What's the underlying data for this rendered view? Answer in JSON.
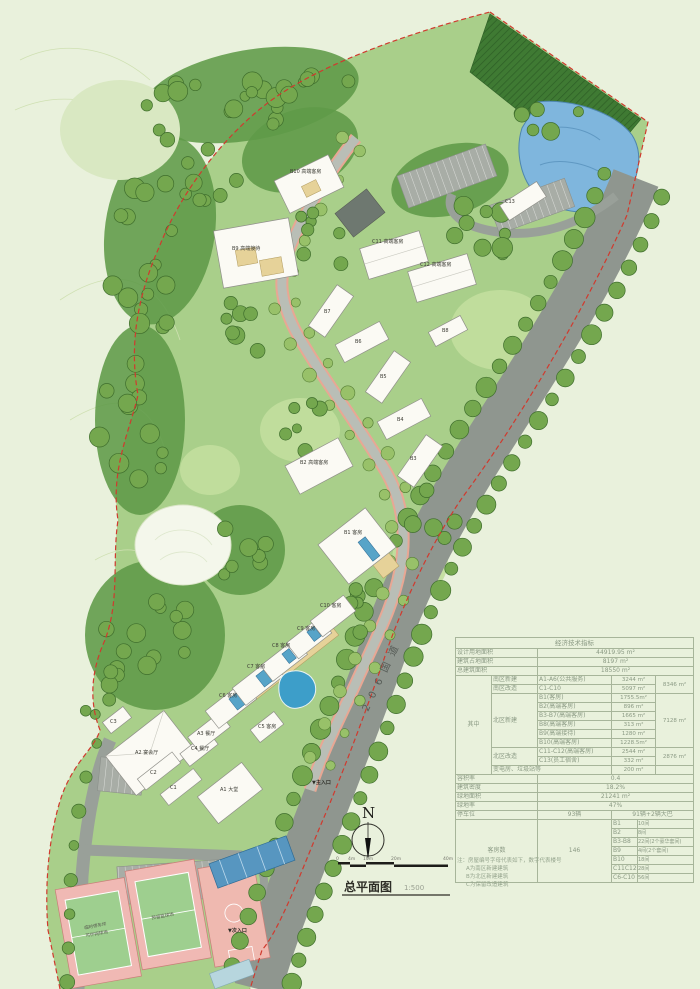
{
  "plan": {
    "title": "总平面图",
    "scale_text": "1:500",
    "north_letter": "N",
    "road_label": "206国道",
    "main_entrance": "▼主入口",
    "secondary_entrance": "▼次入口",
    "scale_ticks": [
      "0",
      "4m",
      "10m",
      "20m",
      "40m"
    ],
    "court_label_line1": "临时停车坪",
    "court_label_line2": "可作网球场",
    "court_label_basketball": "预留篮球场"
  },
  "buildings": {
    "a1": "A1 大堂",
    "a2": "A2 宴会厅",
    "a3": "A3 餐厅",
    "c1": "C1",
    "c2": "C2",
    "c3": "C3",
    "c4": "C4 餐厅",
    "c5": "C5 客房",
    "c6": "C6 客房",
    "c7": "C7 客房",
    "c8": "C8 客房",
    "c9": "C9 客房",
    "c10": "C10 客房",
    "b1": "B1 客房",
    "b2": "B2 高端客房",
    "b3": "B3",
    "b4": "B4",
    "b5": "B5",
    "b6": "B6",
    "b7": "B7",
    "b8": "B8",
    "b9": "B9 高端接待",
    "b10": "B10 高端客房",
    "c11": "C11 高端客房",
    "c12": "C12 高端客房",
    "c13": "C13"
  },
  "table": {
    "title": "经济技术指标",
    "rows": {
      "land_label": "设计用地面积",
      "land_value": "44919.95 m²",
      "footprint_label": "建筑占地面积",
      "footprint_value": "8197 m²",
      "gfa_label": "总建筑面积",
      "gfa_value": "18550 m²",
      "among_label": "其中",
      "south_new_label": "南区新建",
      "south_new_item": "A1-A6(公共服务)",
      "south_new_value": "3244 m²",
      "south_sub_value": "8346 m²",
      "south_ren_label": "南区改造",
      "south_ren_item": "C1-C10",
      "south_ren_value": "5097 m²",
      "north_new_label": "北区新建",
      "b1_item": "B1(客房)",
      "b1_value": "1755.5m²",
      "b2_item": "B2(高端客房)",
      "b2_value": "896 m²",
      "b3_item": "B3-B7(高端客房)",
      "b3_value": "1665 m²",
      "b8_item": "B8(高端客房)",
      "b8_value": "313 m²",
      "b9_item": "B9(高端接待)",
      "b9_value": "1280 m²",
      "b10_item": "B10(高端客房)",
      "b10_value": "1228.5m²",
      "north_sub_value": "7128 m²",
      "north_ren_label": "北区改造",
      "c11_item": "C11-C12(高端客房)",
      "c11_value": "2544 m²",
      "north_ren_sub_value": "2876 m²",
      "c13_item": "C13(员工宿舍)",
      "c13_value": "332 m²",
      "util_label": "变电房、垃圾站等",
      "util_value": "200 m²",
      "far_label": "容积率",
      "far_value": "0.4",
      "density_label": "建筑密度",
      "density_value": "18.2%",
      "green_label": "绿地面积",
      "green_value": "21241 m²",
      "green_rate_label": "绿地率",
      "green_rate_value": "47%",
      "parking_label": "停车位",
      "parking_value": "93辆",
      "parking_detail": "91辆+2辆大巴",
      "rooms_label": "客房数",
      "rooms_total": "146"
    },
    "rooms": [
      [
        "B1",
        "10间"
      ],
      [
        "B2",
        "8间"
      ],
      [
        "B3-B8",
        "22间(2个豪华套间)"
      ],
      [
        "B9",
        "4间(2个套间)"
      ],
      [
        "B10",
        "18间"
      ],
      [
        "C11C12",
        "28间"
      ],
      [
        "C6-C10",
        "56间"
      ]
    ]
  },
  "notes": {
    "line1": "注：房屋编号字母代表如下，数字代表楼号",
    "line2": "A为南区新建建筑",
    "line3": "B为北区新建建筑",
    "line4": "C为保留改造建筑"
  },
  "palette": {
    "site_green": "#a9cf8a",
    "forest_green": "#5f9a48",
    "road_gray": "#8f968f",
    "water_blue": "#7fb6dd",
    "boundary_red": "#d03a2e",
    "courtyard_tan": "#e6d299"
  }
}
